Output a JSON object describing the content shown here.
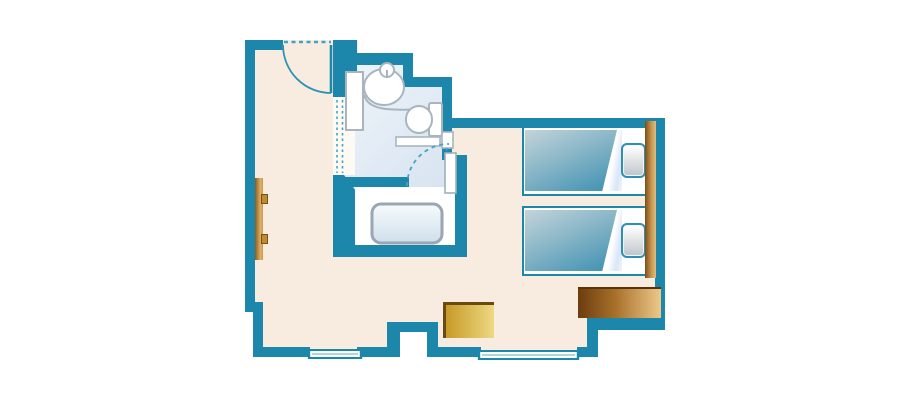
{
  "page": {
    "background": "#ffffff"
  },
  "palette": {
    "wall": "#1d87ab",
    "floor": "#f8ece0",
    "bathFloorLight": "#eef4fa",
    "bathFloorDark": "#d7e3f0",
    "fixtureOutline": "#a9b5be",
    "dashed": "#45a2c6",
    "blanketLight": "#c3d4db",
    "blanketDark": "#4896b5",
    "woodDark": "#7c4c16",
    "woodLight": "#edc98b",
    "goldDark": "#c79a27",
    "goldLight": "#eed982",
    "goldBorder": "#6b4a10"
  },
  "floorplan": {
    "type": "hotel-room-floor-plan",
    "rooms": [
      {
        "name": "entry-hall",
        "floor": "cream"
      },
      {
        "name": "bathroom",
        "floor": "light-blue"
      },
      {
        "name": "tub-room",
        "floor": "white"
      },
      {
        "name": "bedroom",
        "floor": "cream"
      }
    ],
    "fixtures": [
      {
        "name": "entrance-door",
        "style": "swing-arc-with-dashed-threshold"
      },
      {
        "name": "bathroom-door",
        "style": "dashed-swing-arc"
      },
      {
        "name": "washbasin",
        "parts": [
          "vanity",
          "basin-oval",
          "faucet",
          "counter-curve"
        ]
      },
      {
        "name": "toilet",
        "parts": [
          "bowl",
          "tank"
        ]
      },
      {
        "name": "bathtub"
      },
      {
        "name": "shelf"
      },
      {
        "name": "window",
        "count": 2,
        "location": "bottom-wall"
      }
    ],
    "furniture": [
      {
        "name": "bed",
        "count": 2,
        "parts": [
          "blanket",
          "sheet-fold",
          "pillow"
        ]
      },
      {
        "name": "headboard"
      },
      {
        "name": "desk"
      },
      {
        "name": "side-table"
      },
      {
        "name": "wall-rail",
        "knobs": 2
      }
    ]
  }
}
